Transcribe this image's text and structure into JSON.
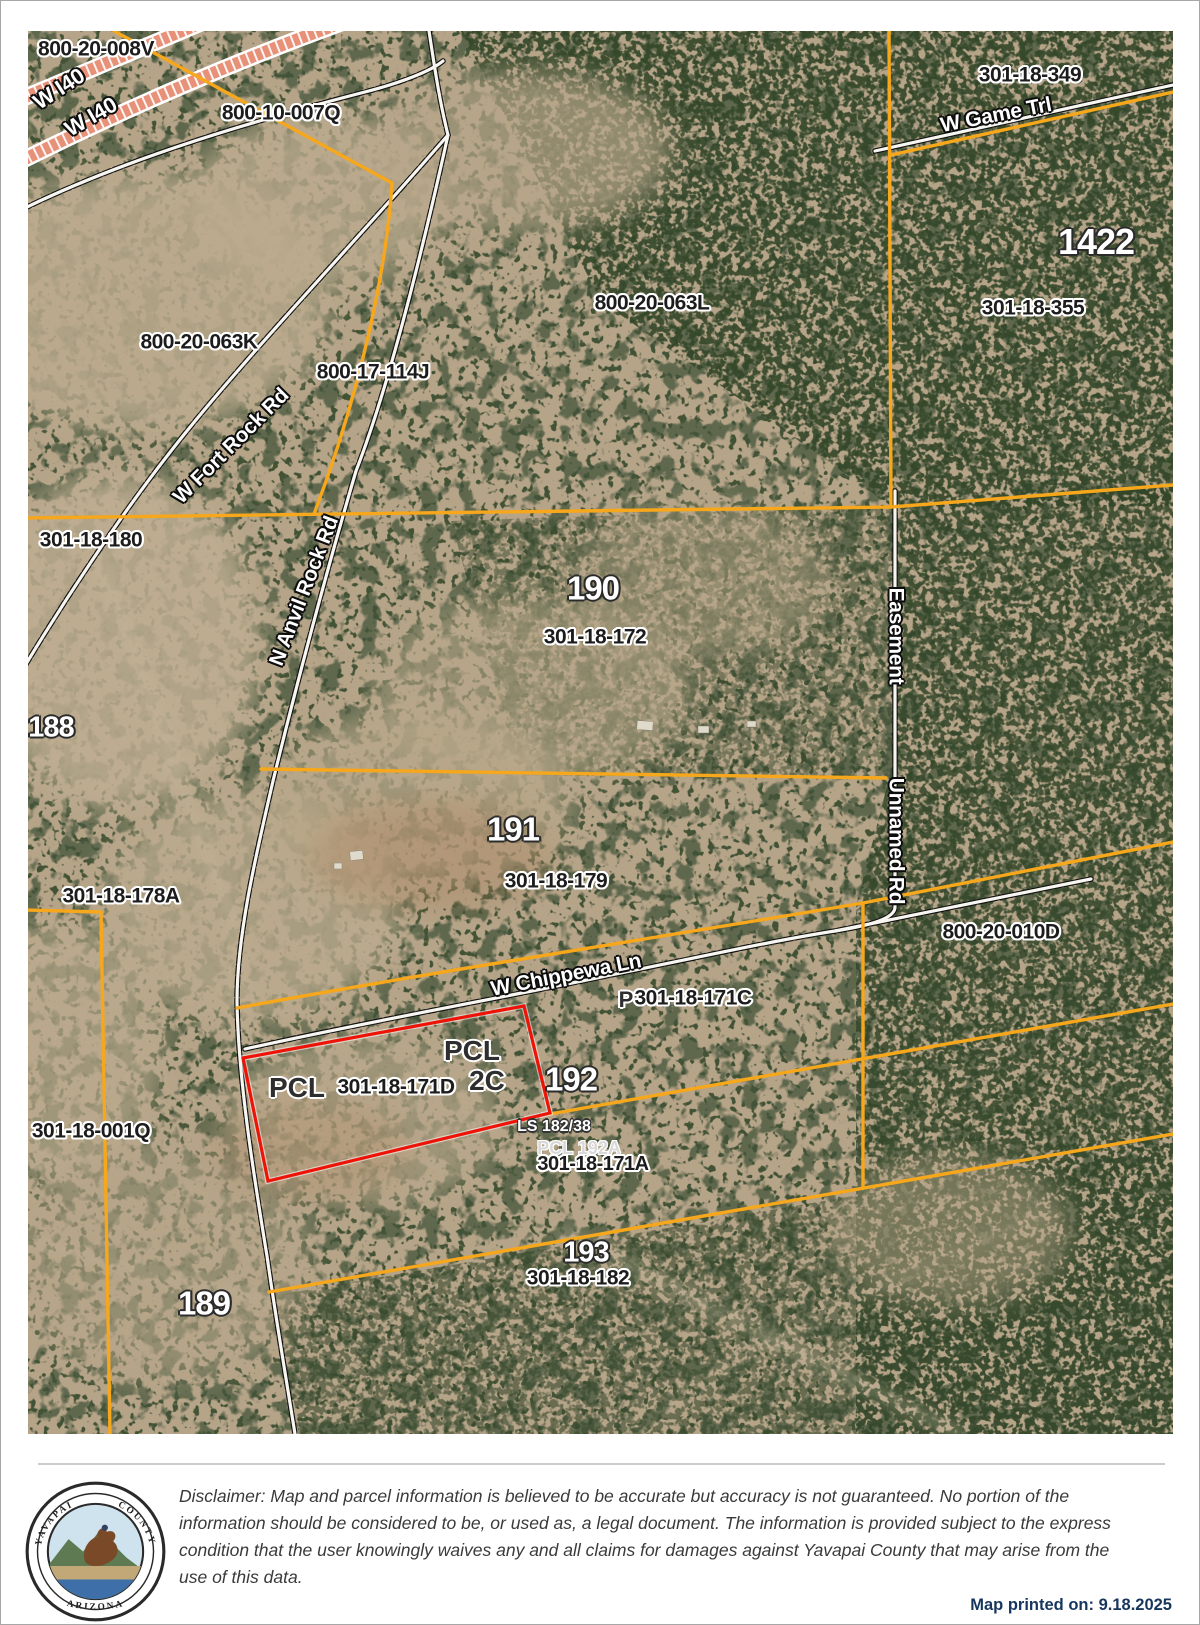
{
  "map": {
    "apn": {
      "v008": "800-20-008V",
      "q007": "800-10-007Q",
      "k063": "800-20-063K",
      "j114": "800-17-114J",
      "l063": "800-20-063L",
      "a349": "301-18-349",
      "a355": "301-18-355",
      "a180": "301-18-180",
      "a172": "301-18-172",
      "a179": "301-18-179",
      "a178": "301-18-178A",
      "d010": "800-20-010D",
      "c171": "301-18-171C",
      "d171": "301-18-171D",
      "a171": "301-18-171A",
      "q001": "301-18-001Q",
      "b182": "301-18-182"
    },
    "numbers": {
      "n1422": "1422",
      "n190": "190",
      "n188": "188",
      "n191": "191",
      "n192": "192",
      "n189": "189",
      "n193": "193"
    },
    "roads": {
      "i40a": "W I40",
      "i40b": "W I40",
      "fort_rock": "W Fort Rock Rd",
      "anvil_rock": "N Anvil Rock Rd",
      "game_trl": "W Game Trl",
      "easement": "Easement",
      "unnamed": "Unnamed Rd",
      "chippewa": "W Chippewa Ln"
    },
    "fragments": {
      "pcl_upper": "PCL",
      "pcl_left": "PCL",
      "tail_2c": "2C",
      "prefix_p": "P",
      "ls_ref": "LS 182/38",
      "pcl_192a": "PCL 192A"
    }
  },
  "footer": {
    "seal": {
      "arc_left": "YAVAPAI",
      "arc_right": "COUNTY",
      "arc_bottom": "ARIZONA"
    },
    "disclaimer": [
      "Disclaimer: Map and parcel information is believed to be accurate but accuracy is not guaranteed. No portion of the",
      "information should be considered to be, or used as, a legal document.  The information is provided subject to the express",
      "condition that the user knowingly waives any and all claims for damages against Yavapai County that may arise from the",
      "use of this data."
    ],
    "printed_on": "Map printed on:  9.18.2025"
  },
  "colors": {
    "parcel_boundary": "#F6A71B",
    "highlight_parcel": "#EE1307",
    "interstate": "#E89179",
    "printed_on_text": "#17365D"
  }
}
